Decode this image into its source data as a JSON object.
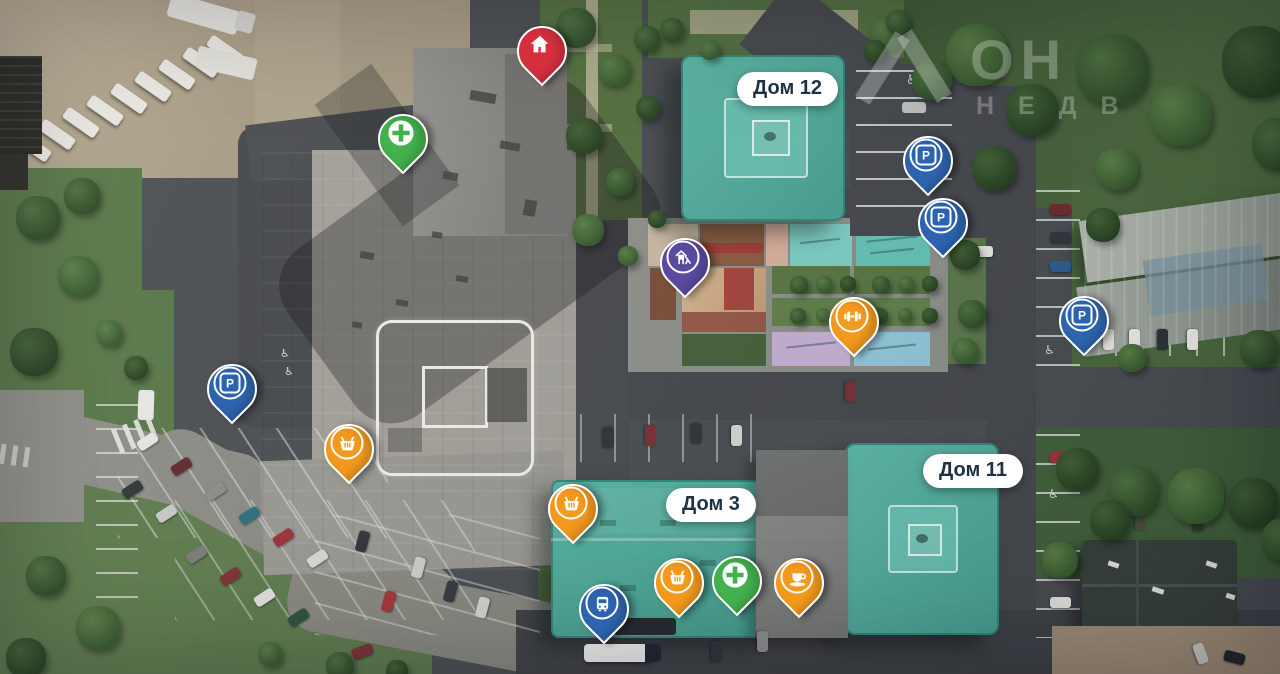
{
  "watermark": {
    "line1": "ОН",
    "line2": "НЕДВ"
  },
  "buildings": [
    {
      "id": "dom12",
      "label": "Дом 12"
    },
    {
      "id": "dom11",
      "label": "Дом 11"
    },
    {
      "id": "dom3",
      "label": "Дом 3"
    }
  ],
  "icons": {
    "parking_letter": "P",
    "disabled_parking": "♿"
  },
  "colors": {
    "pin_red": "#d6303f",
    "pin_green": "#43b14e",
    "pin_blue": "#2e64af",
    "pin_purple": "#5a4b9f",
    "pin_orange": "#f39a1e",
    "building_teal": "#50b2a2",
    "label_bg": "#ffffff",
    "label_text": "#1e3342"
  },
  "pins": [
    {
      "name": "home-pin",
      "icon": "home-icon",
      "kind": "home",
      "color": "#d6303f",
      "x": 540,
      "y": 82
    },
    {
      "name": "pharmacy-pin-north",
      "icon": "medical-cross-icon",
      "kind": "cross",
      "color": "#43b14e",
      "x": 401,
      "y": 170
    },
    {
      "name": "parking-pin-northeast-upper",
      "icon": "parking-icon",
      "kind": "parking",
      "color": "#2e64af",
      "x": 926,
      "y": 192
    },
    {
      "name": "parking-pin-northeast-lower",
      "icon": "parking-icon",
      "kind": "parking",
      "color": "#2e64af",
      "x": 941,
      "y": 254
    },
    {
      "name": "playground-pin",
      "icon": "playground-icon",
      "kind": "playground",
      "color": "#5a4b9f",
      "x": 683,
      "y": 294
    },
    {
      "name": "fitness-pin",
      "icon": "dumbbell-icon",
      "kind": "dumbbell",
      "color": "#f39a1e",
      "x": 852,
      "y": 353
    },
    {
      "name": "parking-pin-east",
      "icon": "parking-icon",
      "kind": "parking",
      "color": "#2e64af",
      "x": 1082,
      "y": 352
    },
    {
      "name": "parking-pin-west",
      "icon": "parking-icon",
      "kind": "parking",
      "color": "#2e64af",
      "x": 230,
      "y": 420
    },
    {
      "name": "shop-pin-west",
      "icon": "basket-icon",
      "kind": "basket",
      "color": "#f39a1e",
      "x": 347,
      "y": 480
    },
    {
      "name": "shop-pin-dom3",
      "icon": "basket-icon",
      "kind": "basket",
      "color": "#f39a1e",
      "x": 571,
      "y": 540
    },
    {
      "name": "shop-pin-south",
      "icon": "basket-icon",
      "kind": "basket",
      "color": "#f39a1e",
      "x": 677,
      "y": 614
    },
    {
      "name": "pharmacy-pin-south",
      "icon": "medical-cross-icon",
      "kind": "cross",
      "color": "#43b14e",
      "x": 735,
      "y": 612
    },
    {
      "name": "cafe-pin",
      "icon": "coffee-icon",
      "kind": "coffee",
      "color": "#f39a1e",
      "x": 797,
      "y": 614
    },
    {
      "name": "bus-stop-pin",
      "icon": "bus-icon",
      "kind": "bus",
      "color": "#2e64af",
      "x": 602,
      "y": 640
    }
  ]
}
